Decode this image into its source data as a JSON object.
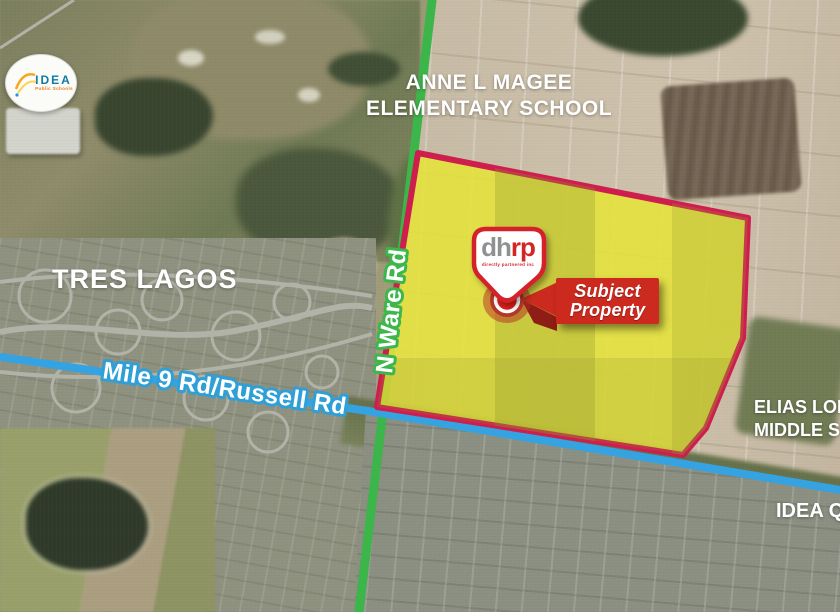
{
  "title": "Aerial subject property map",
  "colors": {
    "boundary_red": "#ce1e4e",
    "banner_red": "#cc2a1f",
    "road_green": "#3cb54a",
    "road_blue": "#35a3e1",
    "property_yellow": "#e5e23a"
  },
  "labels": {
    "school_top_line1": "ANNE L MAGEE",
    "school_top_line2": "ELEMENTARY SCHOOL",
    "neighborhood": "TRES LAGOS",
    "road_vertical": "N Ware Rd",
    "road_horizontal": "Mile 9 Rd/Russell Rd",
    "school_right_line1": "ELIAS LONGORIA",
    "school_right_line2": "MIDDLE SCHOOL",
    "school_bottom_right": "IDEA QUEST"
  },
  "marker": {
    "banner_line1": "Subject",
    "banner_line2": "Property",
    "brand_d": "d",
    "brand_h": "h",
    "brand_rp": "rp",
    "brand_tagline": "directly partnered inc"
  },
  "idea_logo": {
    "text": "IDEA",
    "subtext": "Public Schools"
  }
}
